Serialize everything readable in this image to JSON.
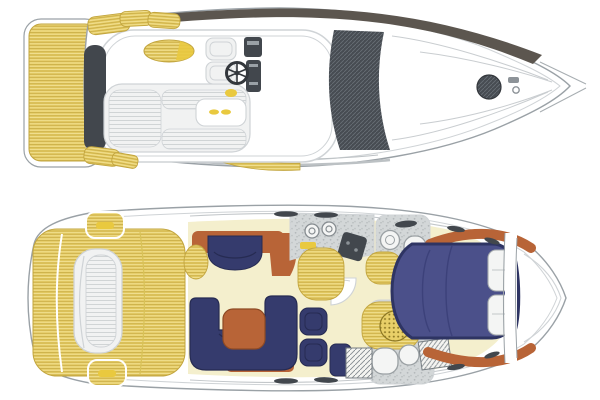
{
  "figure": {
    "description": "Top-down deck plans of a flybridge motor yacht: exterior flybridge deck view above, lower-deck interior accommodation layout below",
    "width_px": 600,
    "height_px": 400
  },
  "colors": {
    "hull": "#ffffff",
    "line": "#9aa1a6",
    "shadow": "#cfd3d6",
    "teak": "#e8cf68",
    "teak_stripe": "#c2a53e",
    "gold": "#e9c93f",
    "band": "#5c564f",
    "slate": "#42474d",
    "navy": "#353b6d",
    "navy_light": "#4b508a",
    "cream": "#f4efcd",
    "wood": "#b86437",
    "counter": "#ccd0d1",
    "fixture": "#f4f5f4",
    "cushion": "#f1f2f2"
  },
  "views": [
    {
      "name": "flybridge-exterior-deck-view",
      "areas": [
        "swim-platform",
        "boarding-steps",
        "flybridge-deck",
        "aft-sun-lounge",
        "flybridge-table",
        "sun-pad",
        "helm-seats",
        "steering-wheel",
        "instrument-panel",
        "hardtop",
        "windscreen",
        "foredeck",
        "deck-hatch",
        "anchor-windlass",
        "bow-pulpit",
        "side-deck-teak"
      ]
    },
    {
      "name": "lower-deck-interior-view",
      "areas": [
        "cockpit-teak-deck",
        "transom-seat",
        "cockpit-steps",
        "saloon-floor",
        "saloon-settee",
        "u-shaped-sofa",
        "saloon-table",
        "armchairs",
        "galley-counter",
        "galley-burners",
        "galley-cooktop",
        "galley-teak-floor",
        "day-head",
        "shower-grate",
        "aft-head",
        "wardrobes",
        "companionway-steps",
        "forward-cabin",
        "island-double-bed",
        "pillows",
        "bow-stowage",
        "hull-windows"
      ]
    }
  ]
}
